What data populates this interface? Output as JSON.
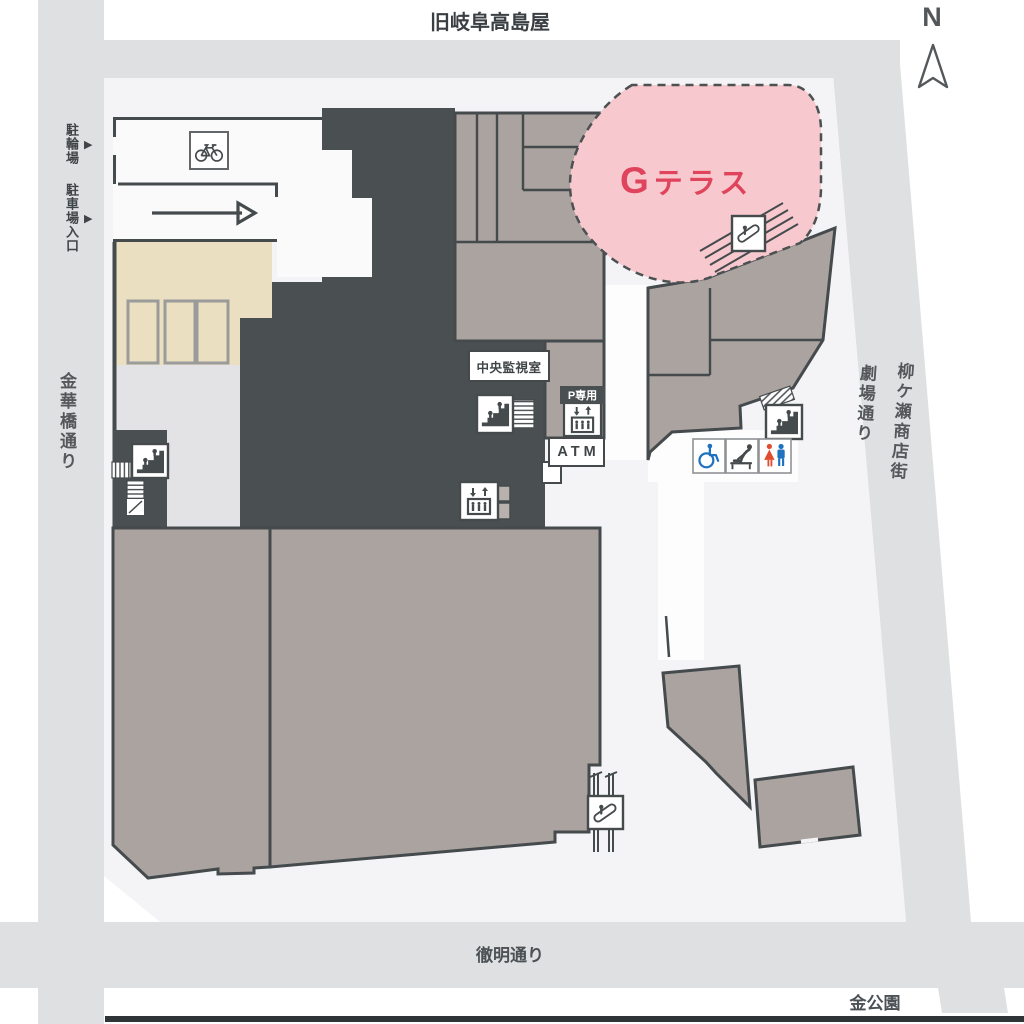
{
  "streets": {
    "top": "旧岐阜高島屋",
    "left": "金華橋通り",
    "theater": "劇場通り",
    "yanagase": "柳ケ瀬商店街",
    "bottom": "徹明通り"
  },
  "places": {
    "park": "金公園",
    "terrace_g": "G",
    "terrace_rest": "テラス",
    "monitor_room": "中央監視室",
    "parking_elevator": "P専用",
    "atm": "ATM"
  },
  "access": {
    "bicycle_parking": "駐輪場",
    "parking_entrance": "駐車場入口",
    "marker": "▶"
  },
  "compass": {
    "north": "N"
  },
  "colors": {
    "road": "#dfe0e1",
    "site": "#f4f4f6",
    "building_dark": "#4a4f52",
    "building_taupe": "#aaa3a0",
    "building_beige": "#ebdfc1",
    "building_light": "#e3e3e5",
    "terrace_pink": "#f7c9ce",
    "terrace_text": "#e0435c",
    "wheelchair_blue": "#1e72c0",
    "restroom_female_red": "#e24b2e",
    "restroom_male_blue": "#1e72c0",
    "wall_dark": "#454a4d"
  },
  "icon_names": [
    "north-arrow-icon",
    "bicycle-icon",
    "direction-arrow-icon",
    "stairs-icon",
    "escalator-icon",
    "elevator-icon",
    "wheelchair-icon",
    "baby-changing-icon",
    "restroom-icon"
  ]
}
